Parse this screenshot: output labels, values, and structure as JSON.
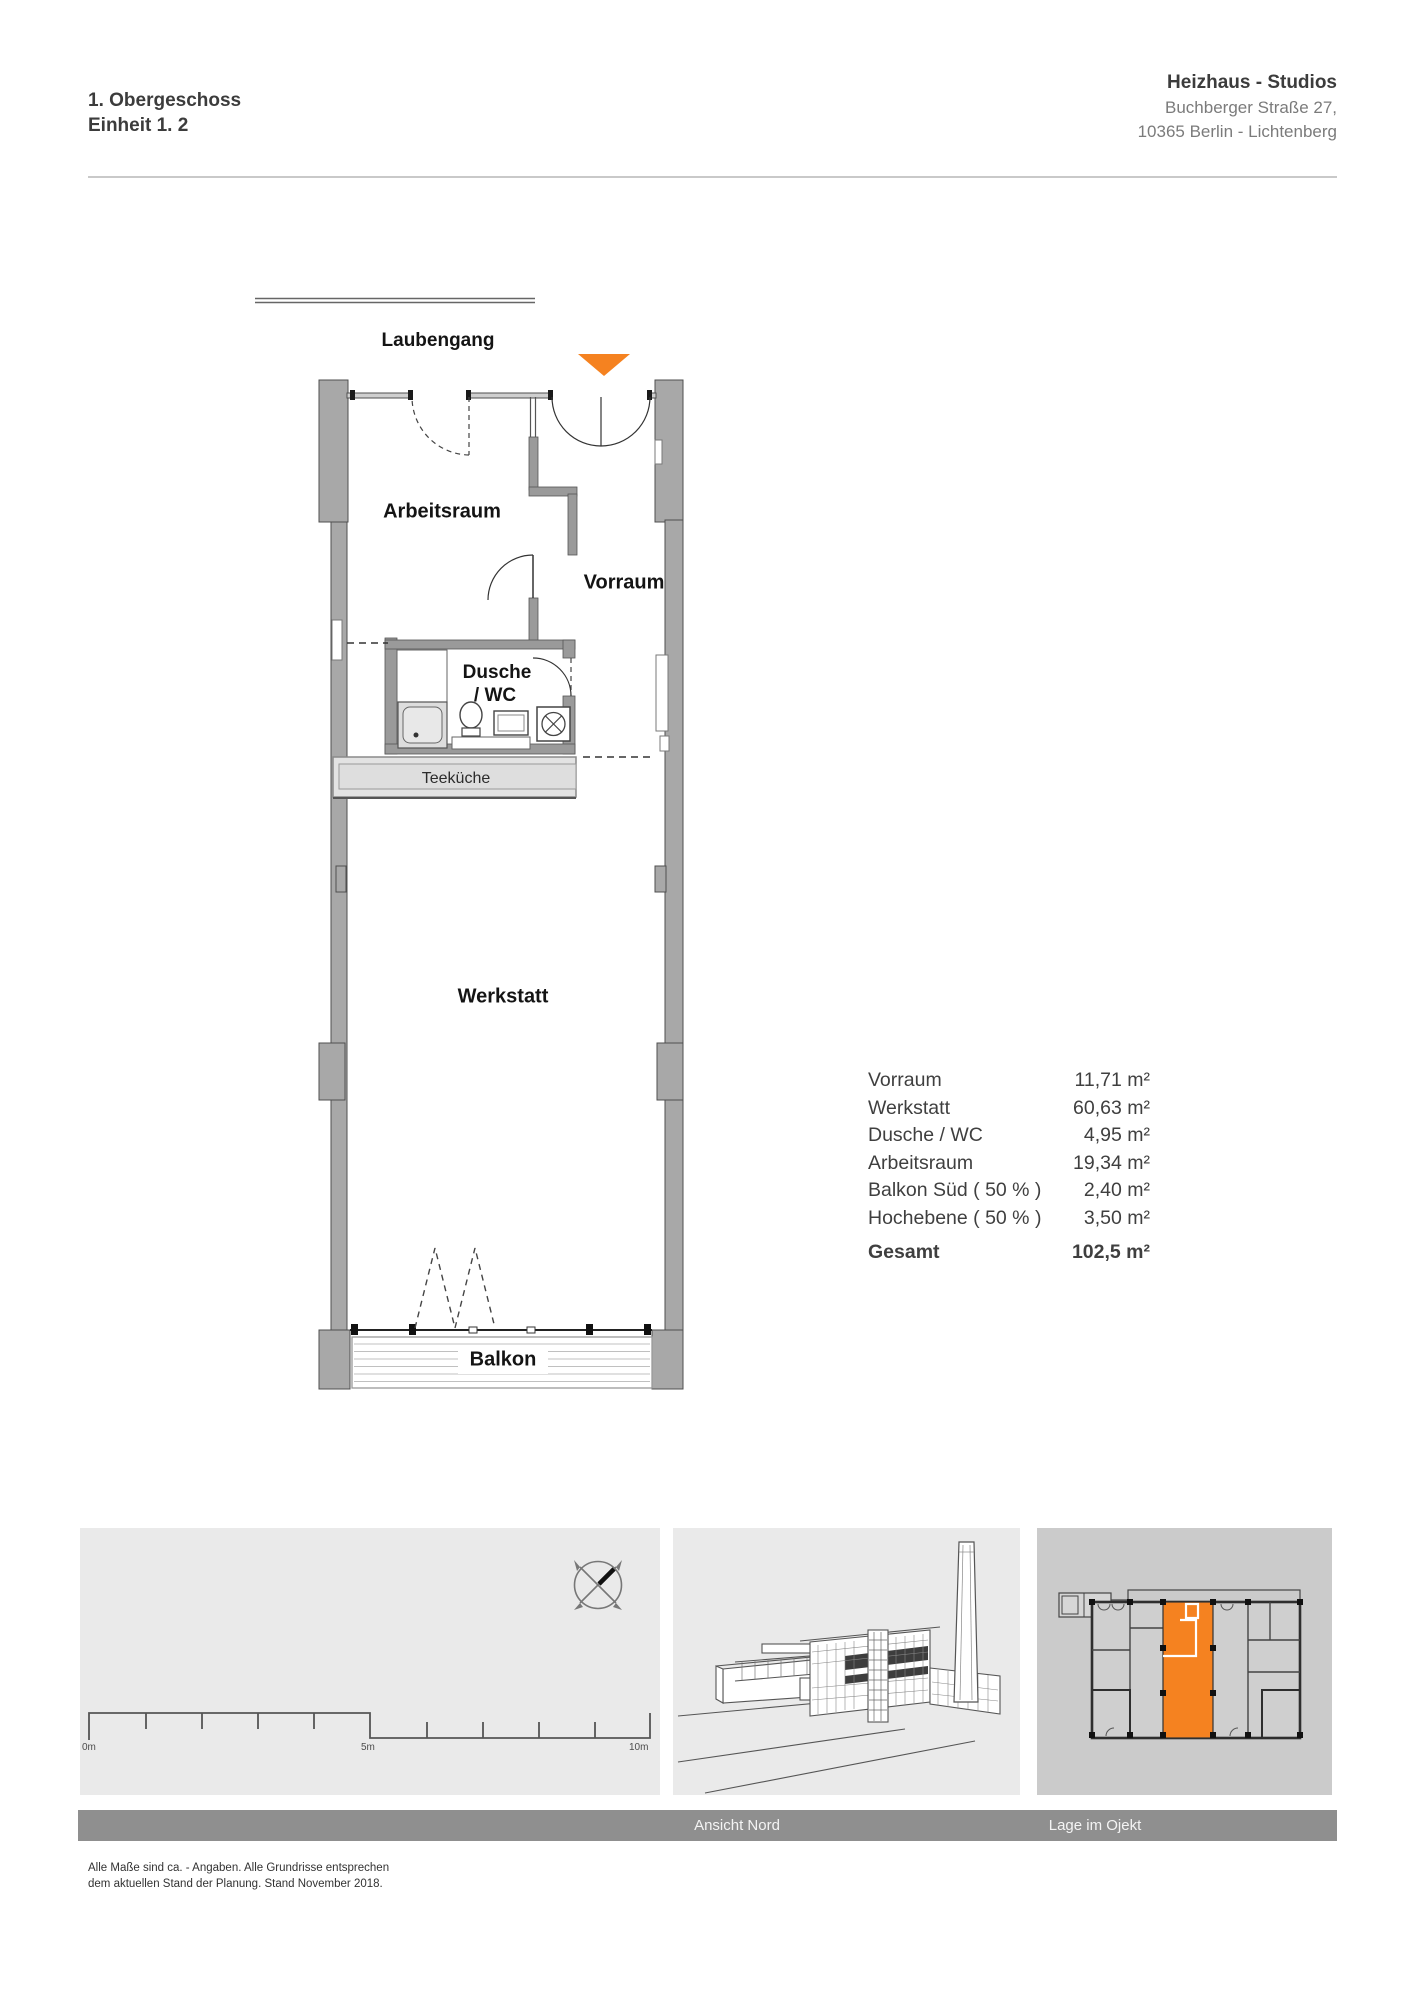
{
  "header": {
    "floor": "1. Obergeschoss",
    "unit": "Einheit 1. 2",
    "project": "Heizhaus - Studios",
    "address_line1": "Buchberger Straße 27,",
    "address_line2": "10365 Berlin - Lichtenberg"
  },
  "plan": {
    "laubengang": "Laubengang",
    "arbeitsraum": "Arbeitsraum",
    "vorraum": "Vorraum",
    "dusche_line1": "Dusche",
    "dusche_line2": "/ WC",
    "teekueche": "Teeküche",
    "werkstatt": "Werkstatt",
    "balkon": "Balkon"
  },
  "areas": {
    "rows": [
      {
        "label": "Vorraum",
        "value": "11,71 m²"
      },
      {
        "label": "Werkstatt",
        "value": "60,63 m²"
      },
      {
        "label": "Dusche / WC",
        "value": "4,95 m²"
      },
      {
        "label": "Arbeitsraum",
        "value": "19,34 m²"
      },
      {
        "label": "Balkon Süd ( 50 % )",
        "value": "2,40 m²"
      },
      {
        "label": "Hochebene ( 50 % )",
        "value": "3,50 m²"
      }
    ],
    "total_label": "Gesamt",
    "total_value": "102,5 m²"
  },
  "scalebar": {
    "t0": "0m",
    "t5": "5m",
    "t10": "10m"
  },
  "captions": {
    "middle": "Ansicht Nord",
    "right": "Lage im Ojekt"
  },
  "footer": {
    "line1": "Alle Maße sind ca. - Angaben. Alle Grundrisse entsprechen",
    "line2": "dem aktuellen Stand der Planung. Stand November 2018."
  },
  "colors": {
    "accent_orange": "#F58220",
    "wall_gray": "#A8A8A8",
    "panel_light": "#EAEAEA",
    "panel_dark": "#CBCBCB",
    "caption_band": "#8F8F8F"
  }
}
